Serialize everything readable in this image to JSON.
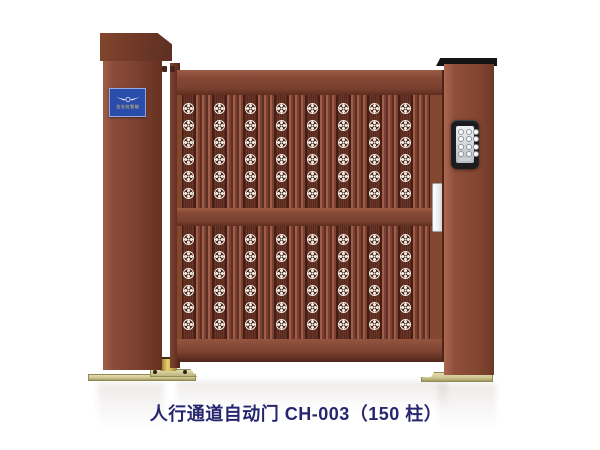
{
  "product": {
    "caption": "人行通道自动门 CH-003（150 柱）"
  },
  "brand_plaque": {
    "logo": "wings-emblem-icon",
    "text": "金长虹智能",
    "bg_color": "#2a4dab",
    "text_color": "#e8c56a"
  },
  "keypad": {
    "rows": 4,
    "cols": 3,
    "housing_color": "#1c1c20",
    "panel_color": "#dfe1e4"
  },
  "gate": {
    "pattern": {
      "sections": 2,
      "columns": 8,
      "rosettes_per_column": 6
    }
  },
  "colors": {
    "gate_body": "#8a4b38",
    "gate_dark_seam": "#4e241a",
    "rib_light": "#a25c47",
    "panel_background": "#57291e",
    "rosette": "#f2ece2",
    "pillar_cap_black": "#141414",
    "base_plate": "#d9d0a2",
    "caster_brass": "#ecd06c",
    "caption_text": "#26266f",
    "background": "#ffffff"
  }
}
